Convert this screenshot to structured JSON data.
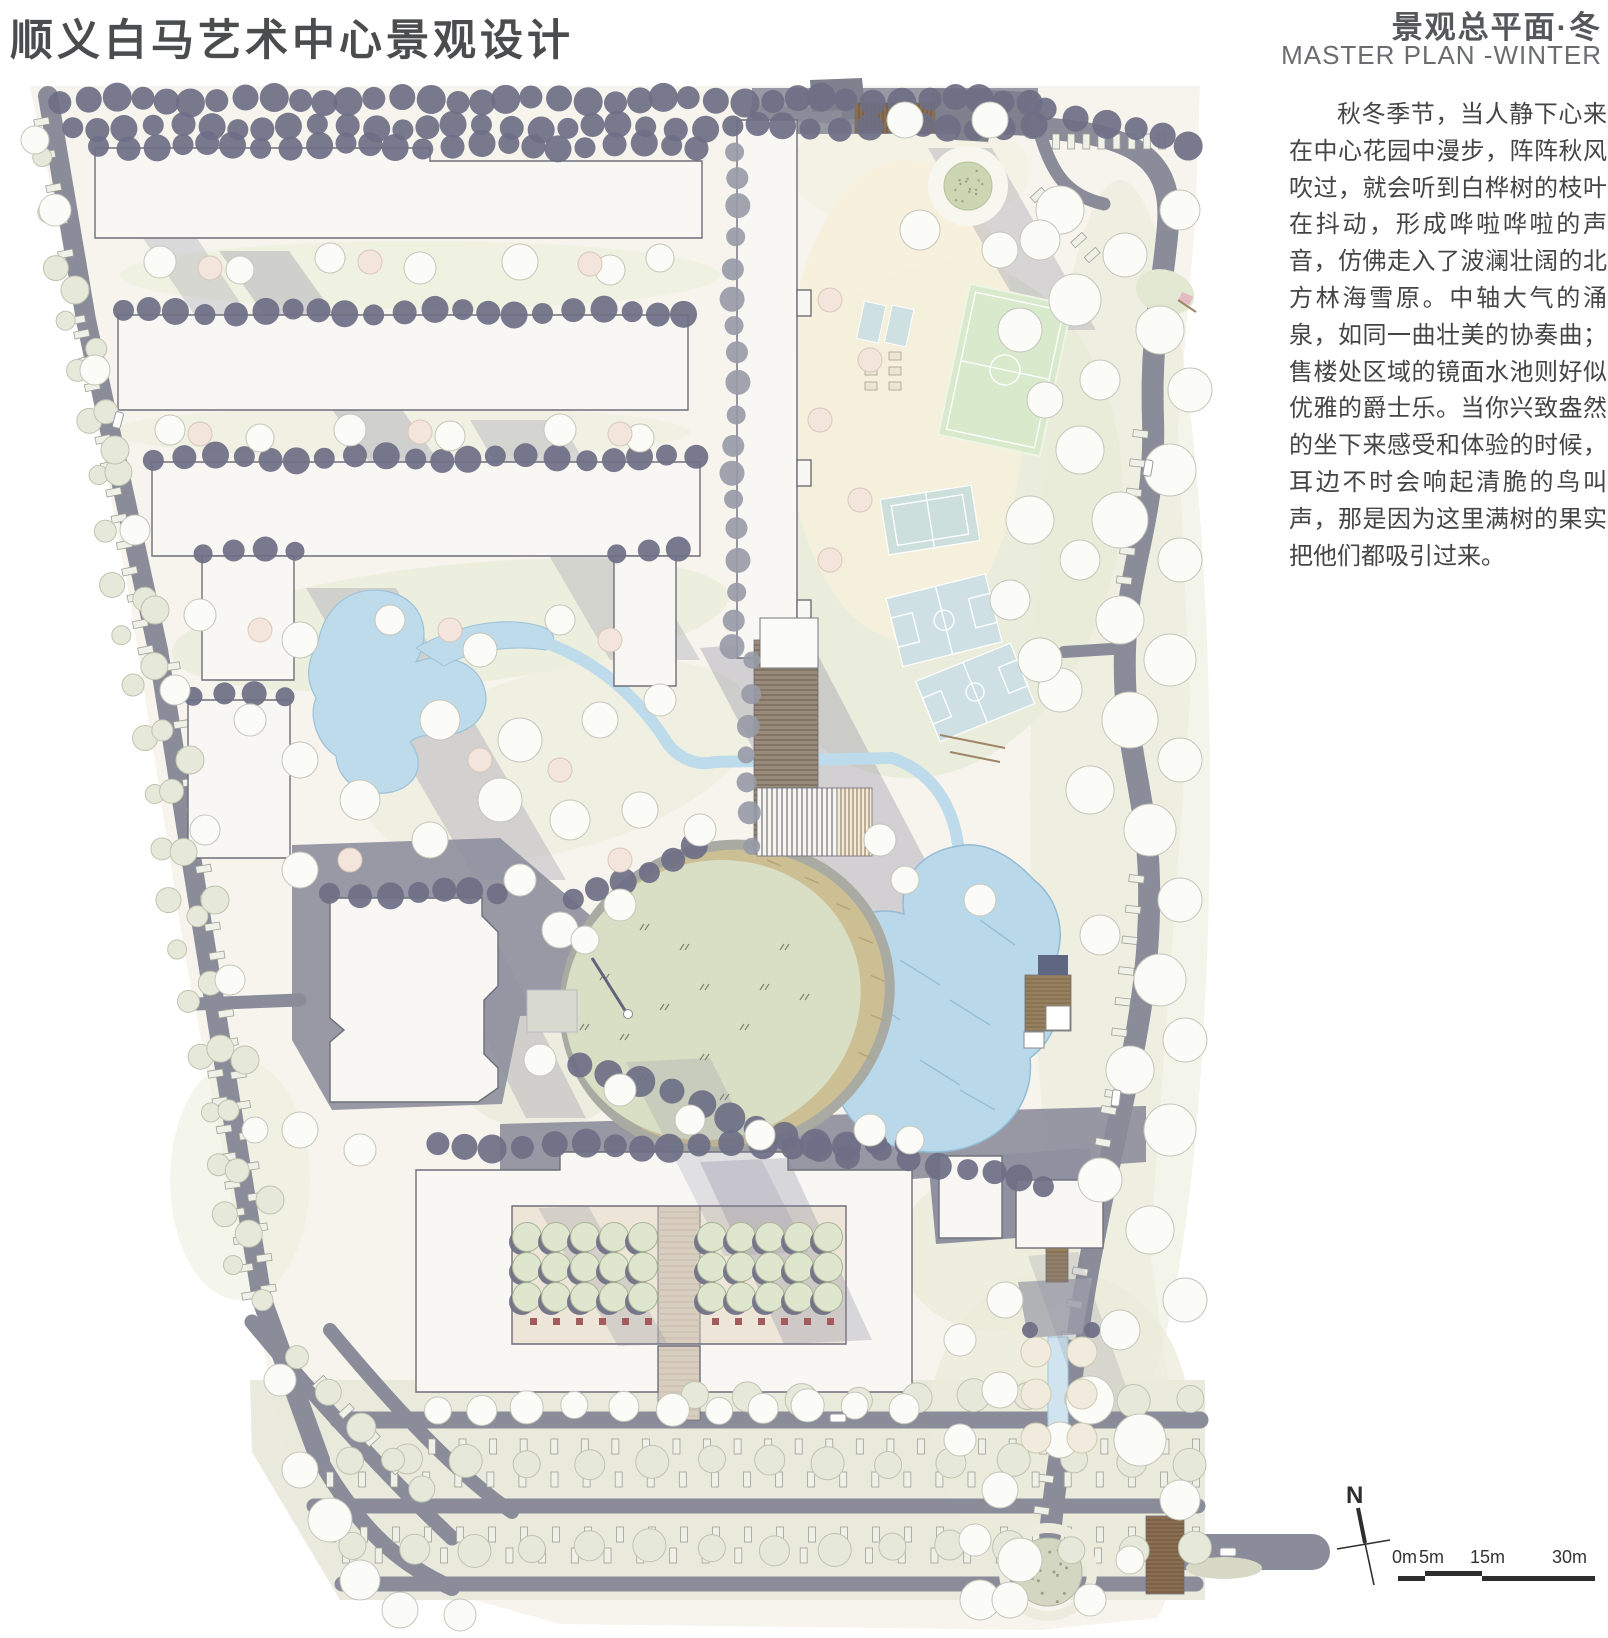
{
  "board": {
    "title": "顺义白马艺术中心景观设计"
  },
  "header": {
    "plan_title_zh": "景观总平面·冬",
    "plan_title_en": "MASTER PLAN -WINTER"
  },
  "description": {
    "text": "秋冬季节，当人静下心来在中心花园中漫步，阵阵秋风吹过，就会听到白桦树的枝叶在抖动，形成哗啦哗啦的声音，仿佛走入了波澜壮阔的北方林海雪原。中轴大气的涌泉，如同一曲壮美的协奏曲；售楼处区域的镜面水池则好似优雅的爵士乐。当你兴致盎然的坐下来感受和体验的时候，耳边不时会响起清脆的鸟叫声，那是因为这里满树的果实把他们都吸引过来。"
  },
  "compass": {
    "label": "N"
  },
  "scale_bar": {
    "labels": [
      "0m",
      "5m",
      "15m",
      "30m"
    ]
  },
  "icons": {
    "north_arrow": "compass-needle-cross",
    "scale_bar": "alternating-segment-bar"
  },
  "colors": {
    "road": "#8a8c99",
    "building": "#f8f7f4",
    "dark_tree": "#6e6f85",
    "water": "#bedbeb",
    "lawn_oval": "#d9dfc5",
    "sand_edge": "#cdbf94",
    "soccer_green": "#d9e9cc",
    "court_blue": "#cfe0e4",
    "wood_structure": "#8a6f52",
    "ground": "#f6f4ec"
  }
}
